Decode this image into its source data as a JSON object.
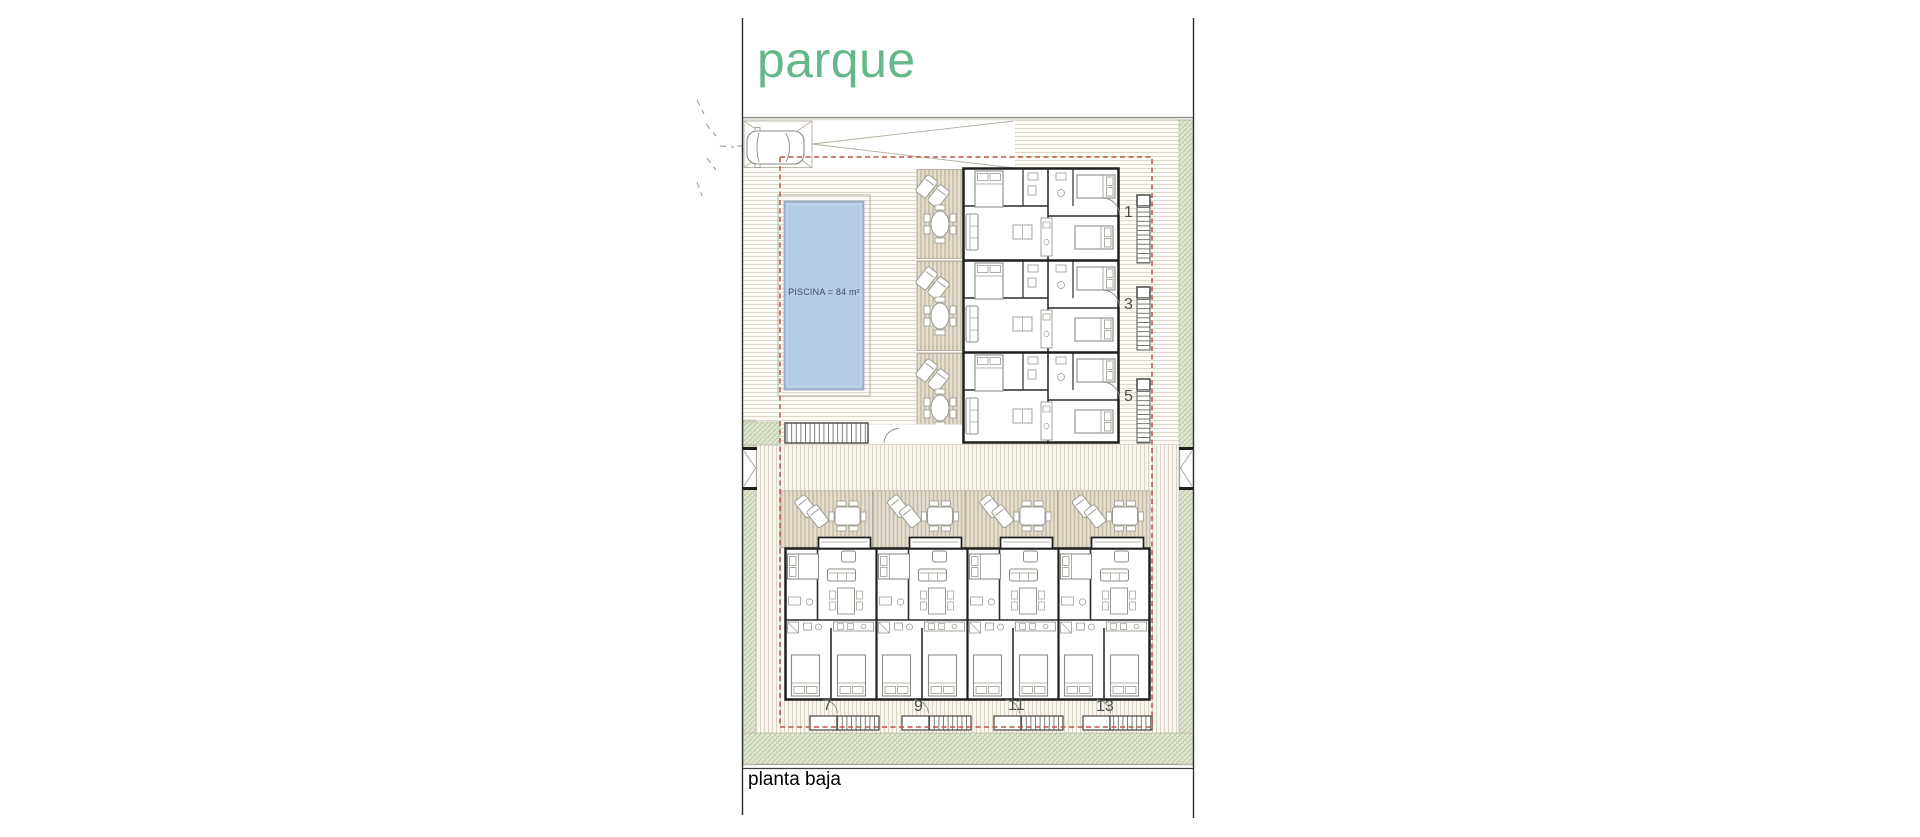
{
  "labels": {
    "park": "parque",
    "floor": "planta baja"
  },
  "pool": {
    "label": "PISCINA = 84 m²",
    "area_m2": 84
  },
  "units": {
    "upper": [
      {
        "label": "1"
      },
      {
        "label": "3"
      },
      {
        "label": "5"
      }
    ],
    "lower": [
      {
        "label": "7"
      },
      {
        "label": "9"
      },
      {
        "label": "11"
      },
      {
        "label": "13"
      }
    ]
  },
  "colors": {
    "park_green": "#63b98b",
    "pool_blue": "#b4cce7",
    "boundary_red": "#c0524a",
    "hedge_green": "#e4e9da",
    "terrace_beige": "#e5ded0",
    "wall_black": "#1f1f1f"
  }
}
